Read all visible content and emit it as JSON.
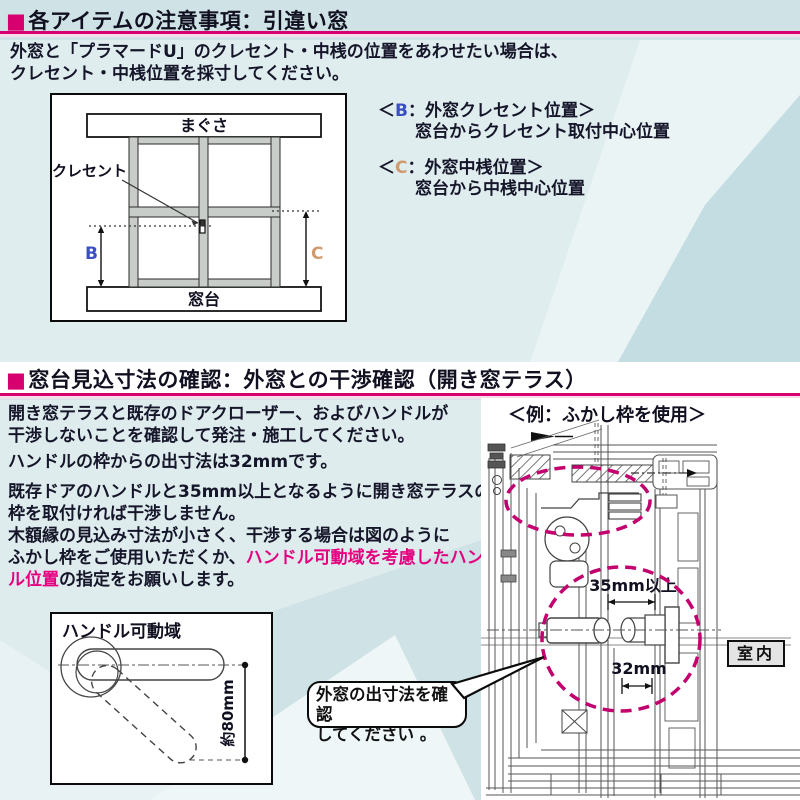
{
  "colors": {
    "accent_magenta": "#d6006e",
    "highlight_pink": "#e5007f",
    "dim_b_blue": "#3a50c2",
    "dim_c_tan": "#cf9a6e"
  },
  "section1": {
    "marker": "■",
    "title": "各アイテムの注意事項：引違い窓",
    "intro_line1": "外窓と「プラマードU」のクレセント・中桟の位置をあわせたい場合は、",
    "intro_line2": "クレセント・中桟位置を採寸してください。",
    "diagram": {
      "lintel": "まぐさ",
      "crescent": "クレセント",
      "sill": "窓台",
      "dim_b": "B",
      "dim_c": "C"
    },
    "note_b": {
      "open": "＜",
      "key": "B",
      "rest": "：外窓クレセント位置＞",
      "desc": "窓台からクレセント取付中心位置"
    },
    "note_c": {
      "open": "＜",
      "key": "C",
      "rest": "：外窓中桟位置＞",
      "desc": "窓台から中桟中心位置"
    }
  },
  "section2": {
    "marker": "■",
    "title": "窓台見込寸法の確認：外窓との干渉確認（開き窓テラス）",
    "para1_line1": "開き窓テラスと既存のドアクローザー、およびハンドルが",
    "para1_line2": "干渉しないことを確認して発注・施工してください。",
    "para2": "ハンドルの枠からの出寸法は32mmです。",
    "para3_line1": "既存ドアのハンドルと35mm以上となるように開き窓テラスの",
    "para3_line2": "枠を取付ければ干渉しません。",
    "para3_line3": "木額縁の見込み寸法が小さく、干渉する場合は図のように",
    "para3_line4_pre": "ふかし枠をご使用いただくか、",
    "para3_line4_hl": "ハンドル可動域を考慮したハンド",
    "para3_line5_hl": "ル位置",
    "para3_line5_post": "の指定をお願いします。",
    "example_label": "＜例：ふかし枠を使用＞",
    "handle_diagram": {
      "title": "ハンドル可動域",
      "dim": "約80mm"
    },
    "drawing": {
      "dim_35": "35mm以上",
      "dim_32": "32mm",
      "room": "室内"
    },
    "callout": {
      "line1": "外窓の出寸法を確認",
      "line2": "してください 。"
    }
  }
}
